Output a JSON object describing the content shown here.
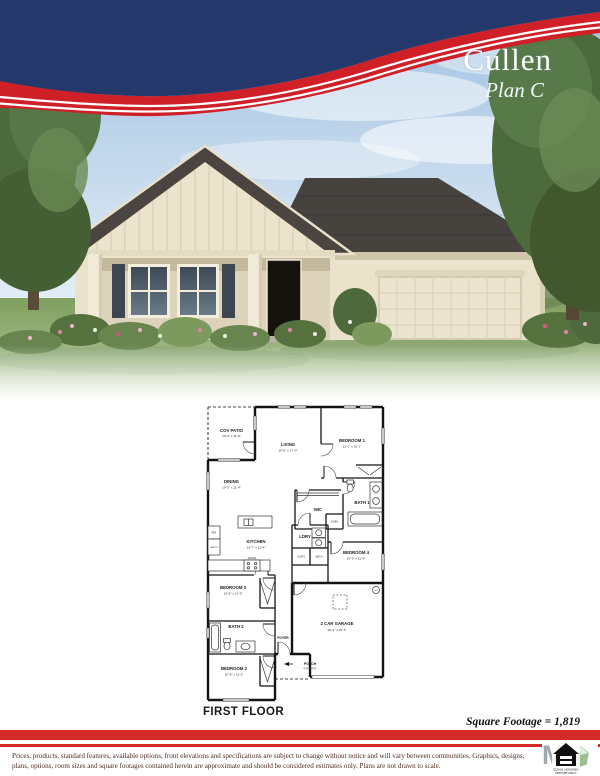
{
  "header": {
    "plan_name": "Cullen",
    "plan_variant": "Plan C",
    "colors": {
      "navy": "#24386b",
      "red": "#cf2027"
    }
  },
  "floor_plan": {
    "title": "FIRST FLOOR",
    "square_footage": "Square Footage = 1,819",
    "rooms": {
      "cov_patio": {
        "name": "COV PATIO",
        "dims": "10'-0\" x 11'-0\""
      },
      "living": {
        "name": "LIVING",
        "dims": "16'-0\" x 17'-0\""
      },
      "bedroom1": {
        "name": "BEDROOM 1",
        "dims": "13'-1\" x 15'-1\""
      },
      "dining": {
        "name": "DINING",
        "dims": "10'-0\" x 11'-4\""
      },
      "wic": {
        "name": "WIC"
      },
      "bath1": {
        "name": "BATH 1"
      },
      "kitchen": {
        "name": "KITCHEN",
        "dims": "13'-7\" x 11'-4\""
      },
      "ldry": {
        "name": "LDRY"
      },
      "bedroom4": {
        "name": "BEDROOM 4",
        "dims": "10'-9\" x 11'-9\""
      },
      "bedroom3": {
        "name": "BEDROOM 3",
        "dims": "10'-8\" x 11'-3\""
      },
      "bath2": {
        "name": "BATH 2"
      },
      "foyer": {
        "name": "FOYER"
      },
      "bedroom2": {
        "name": "BEDROOM 2",
        "dims": "10'-8\" x 11'-3\""
      },
      "garage": {
        "name": "2 CAR GARAGE",
        "dims": "20'-1\" x 20'-1\""
      },
      "porch": {
        "name": "PORCH",
        "dims": "4'-8\" x 4'-0\""
      }
    },
    "closet_labels": {
      "linen": "LINEN",
      "coats": "COATS",
      "mech": "MECH",
      "pantry": "PANTRY",
      "ref": "REF",
      "range": "RANGE",
      "wh": "WH"
    }
  },
  "footer": {
    "disclaimer_line1": "Prices, products, standard features, available options, front elevations and specifications are subject to change without notice and will vary between communities.  Graphics, designs,",
    "disclaimer_line2": "plans, options, room sizes and square footages contained herein are approximate and should be considered estimates only.  Plans are not drawn to scale.",
    "logo": {
      "watermark": "M",
      "line1": "EQUAL HOUSING",
      "line2": "OPPORTUNITY"
    }
  }
}
